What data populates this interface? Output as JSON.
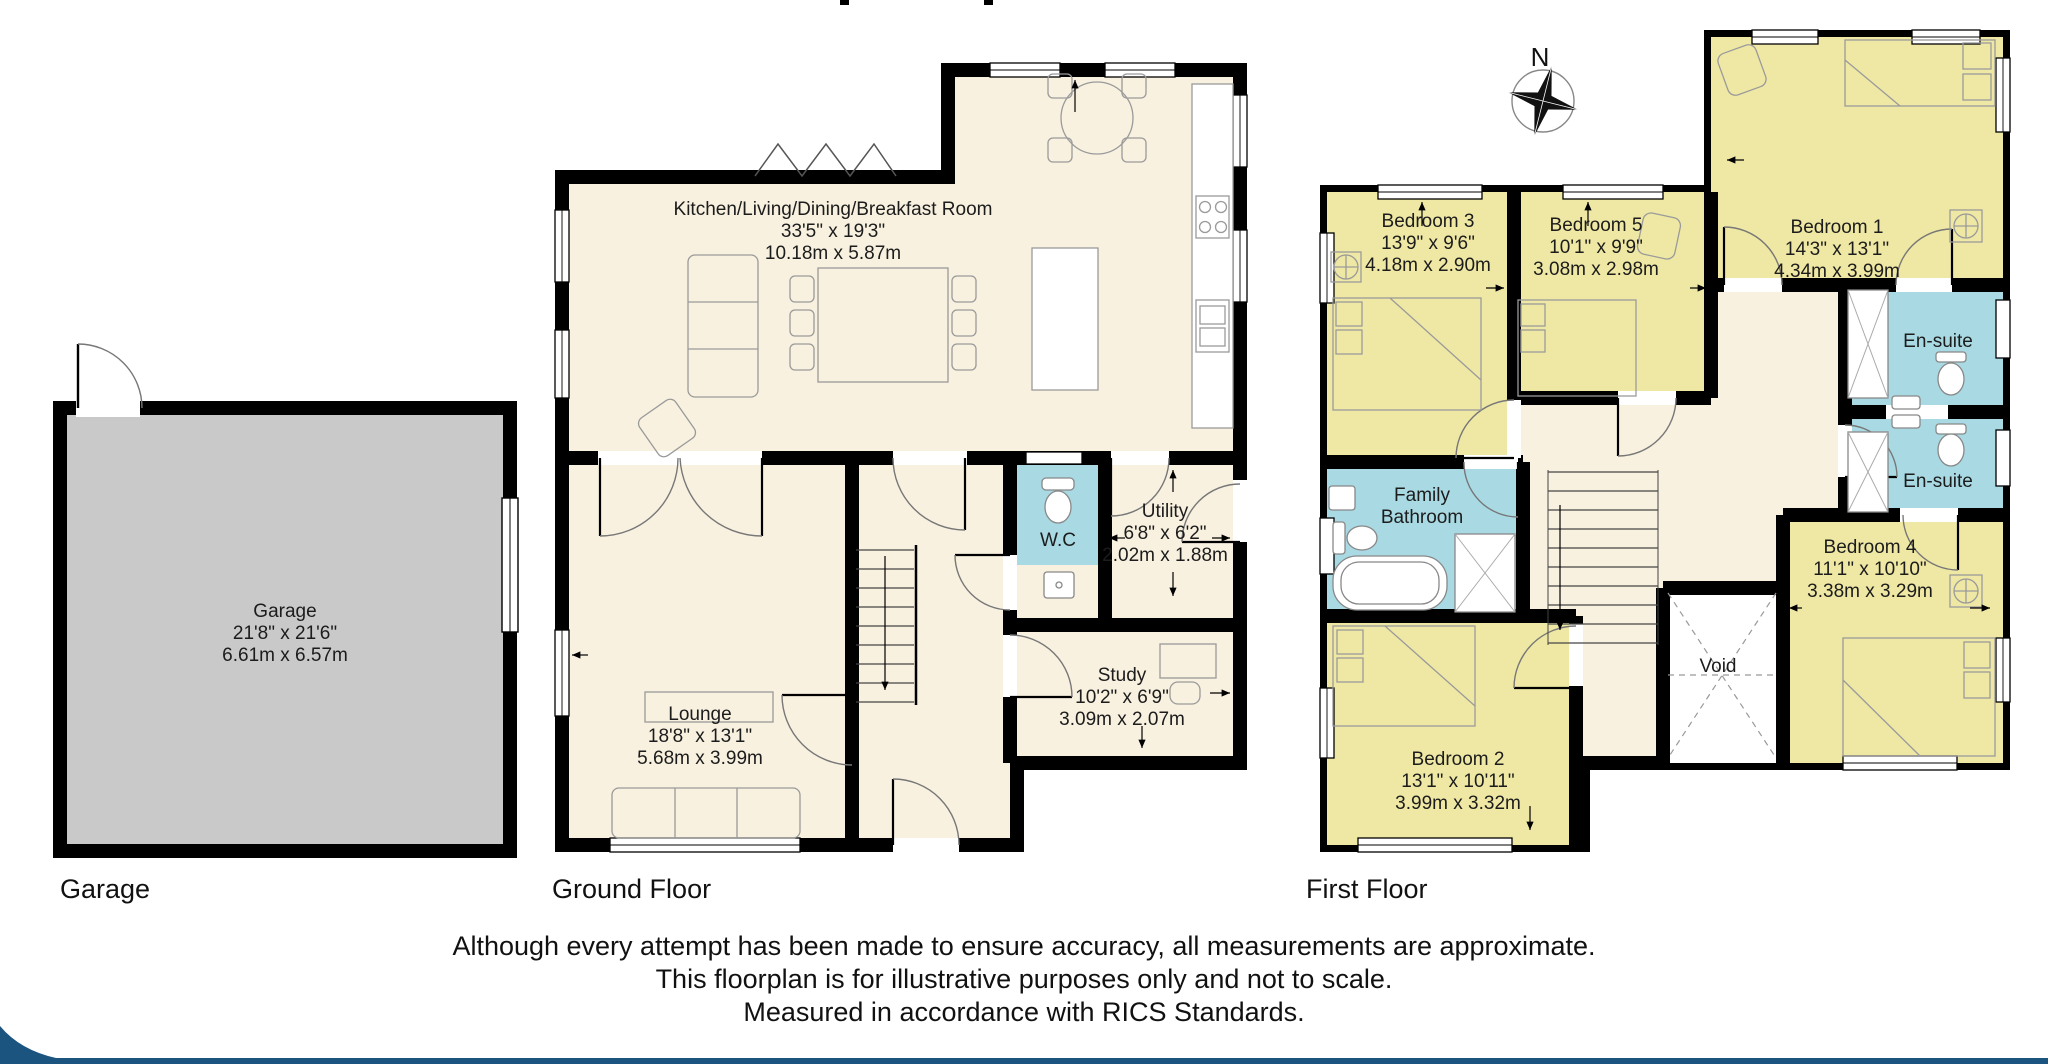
{
  "captions": {
    "garage": "Garage",
    "ground_floor": "Ground Floor",
    "first_floor": "First Floor"
  },
  "compass": {
    "north": "N"
  },
  "rooms": {
    "garage": {
      "name": "Garage",
      "imperial": "21'8\" x 21'6\"",
      "metric": "6.61m x 6.57m"
    },
    "kitchen": {
      "name": "Kitchen/Living/Dining/Breakfast Room",
      "imperial": "33'5\" x 19'3\"",
      "metric": "10.18m x 5.87m"
    },
    "lounge": {
      "name": "Lounge",
      "imperial": "18'8\" x 13'1\"",
      "metric": "5.68m x 3.99m"
    },
    "wc": {
      "name": "W.C"
    },
    "utility": {
      "name": "Utility",
      "imperial": "6'8\" x 6'2\"",
      "metric": "2.02m x 1.88m"
    },
    "study": {
      "name": "Study",
      "imperial": "10'2\" x 6'9\"",
      "metric": "3.09m x 2.07m"
    },
    "bedroom1": {
      "name": "Bedroom 1",
      "imperial": "14'3\" x 13'1\"",
      "metric": "4.34m x 3.99m"
    },
    "bedroom2": {
      "name": "Bedroom 2",
      "imperial": "13'1\" x 10'11\"",
      "metric": "3.99m x 3.32m"
    },
    "bedroom3": {
      "name": "Bedroom 3",
      "imperial": "13'9\" x 9'6\"",
      "metric": "4.18m x 2.90m"
    },
    "bedroom4": {
      "name": "Bedroom 4",
      "imperial": "11'1\" x 10'10\"",
      "metric": "3.38m x 3.29m"
    },
    "bedroom5": {
      "name": "Bedroom 5",
      "imperial": "10'1\" x 9'9\"",
      "metric": "3.08m x 2.98m"
    },
    "ensuite_top": {
      "name": "En-suite"
    },
    "ensuite_bottom": {
      "name": "En-suite"
    },
    "family_bathroom": {
      "name": "Family Bathroom"
    },
    "void": {
      "name": "Void"
    }
  },
  "disclaimer": {
    "line1": "Although every attempt has been made to ensure accuracy, all measurements are approximate.",
    "line2": "This floorplan is for illustrative purposes only and not to scale.",
    "line3": "Measured in accordance with RICS Standards."
  },
  "colors": {
    "room_cream": "#F8F1E0",
    "bedroom_yellow": "#EFE8A4",
    "wet_room_cyan": "#A9DAE4",
    "garage_gray": "#C9C9C9",
    "wall_black": "#000000",
    "footer_blue": "#1C5480"
  }
}
